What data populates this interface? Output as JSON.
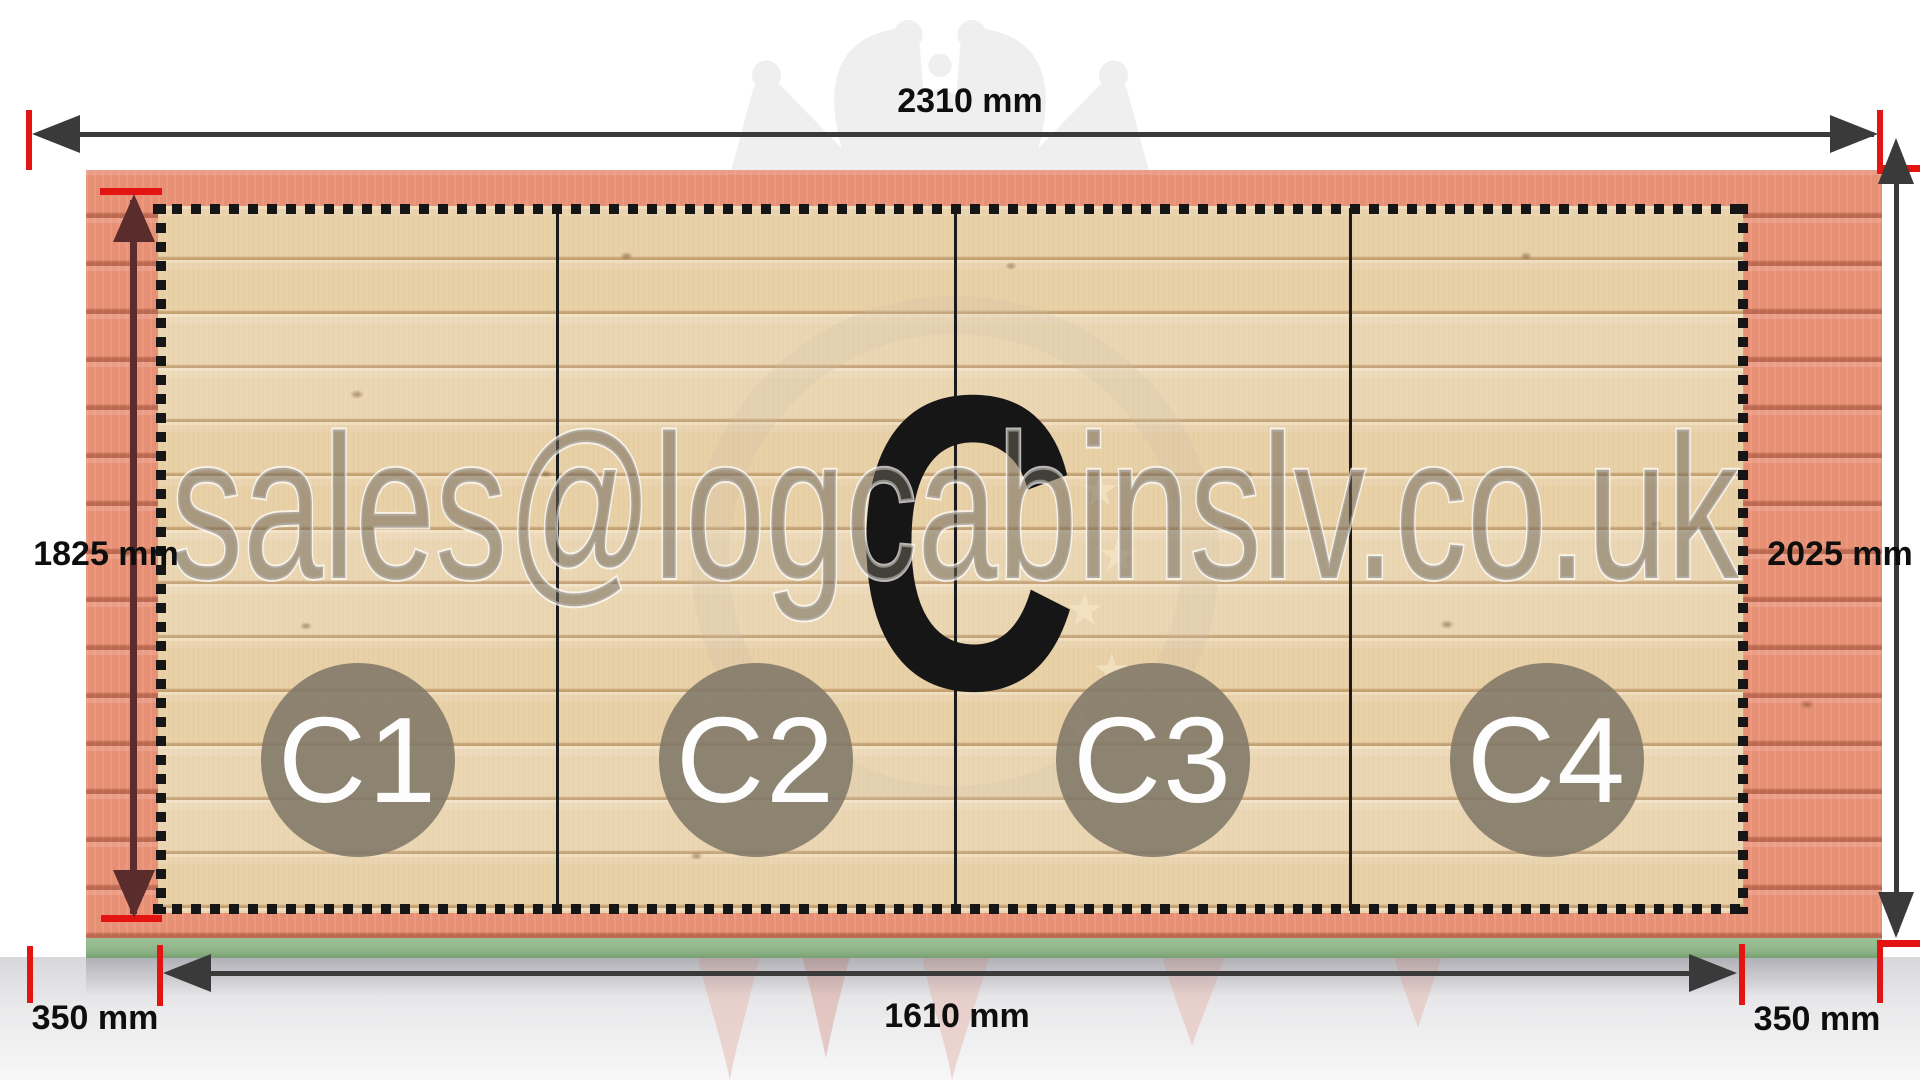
{
  "watermark": {
    "email": "sales@logcabinslv.co.uk"
  },
  "panel": {
    "big_letter": "C"
  },
  "sections": [
    {
      "label": "C1"
    },
    {
      "label": "C2"
    },
    {
      "label": "C3"
    },
    {
      "label": "C4"
    }
  ],
  "dimensions": {
    "top_width": "2310 mm",
    "left_height": "1825 mm",
    "right_height": "2025 mm",
    "bottom_width": "1610 mm",
    "bottom_left_offset": "350 mm",
    "bottom_right_offset": "350 mm"
  },
  "colors": {
    "tick_red": "#e31411",
    "dim_line_dark": "#3a3a3a",
    "left_dim_maroon": "#5a2c2c",
    "outer_wood_pink": "#ec9379",
    "inner_wood_tan": "#e9d2ab",
    "foundation_green": "#8fb689",
    "section_circle_gray": "#807768",
    "big_letter_black": "#161616"
  }
}
